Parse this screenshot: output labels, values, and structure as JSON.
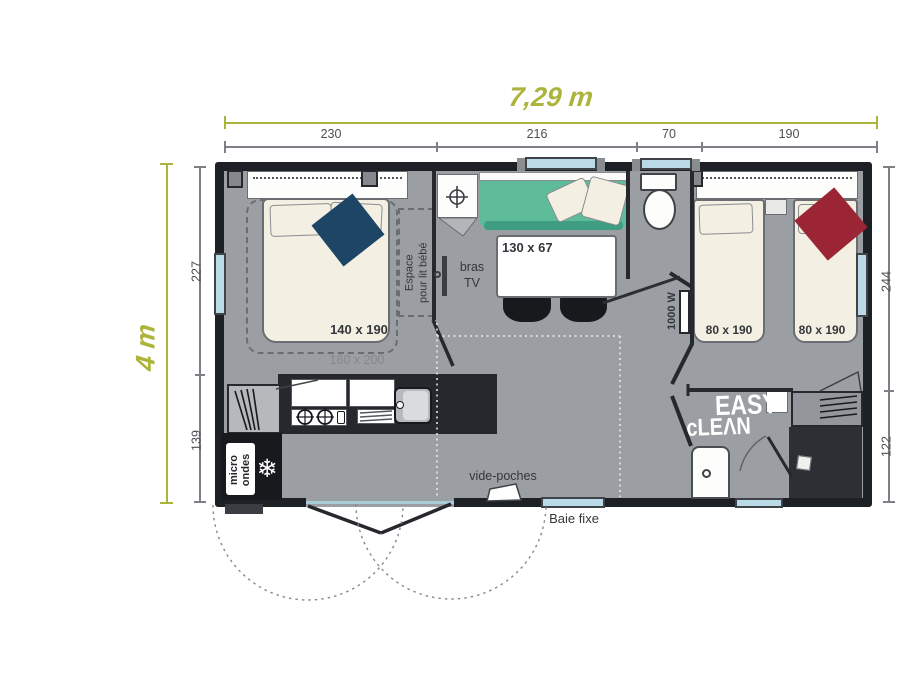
{
  "dimensions": {
    "overall_width": "7,29 m",
    "overall_height": "4 m",
    "top_segments": [
      "230",
      "216",
      "70",
      "190"
    ],
    "left_segments": [
      "227",
      "139"
    ],
    "right_segments": [
      "244",
      "122"
    ]
  },
  "rooms": {
    "master_bedroom": {
      "bed_size": "140 x 190",
      "bed_option_size": "160 x 200",
      "baby_space_line1": "Espace",
      "baby_space_line2": "pour lit bébé"
    },
    "living": {
      "table_size": "130 x 67",
      "tv_line1": "bras",
      "tv_line2": "TV"
    },
    "wc": {
      "heater_power": "1000 W"
    },
    "kids_bedroom": {
      "bed1_size": "80 x 190",
      "bed2_size": "80 x 190"
    },
    "bathroom": {
      "logo_line1": "EASY",
      "logo_line2": "cLEΛN"
    },
    "kitchen": {
      "microwave_line1": "micro",
      "microwave_line2": "ondes",
      "freezer_icon": "❄"
    }
  },
  "annotations": {
    "pocket": "vide-poches",
    "fixed_bay": "Baie fixe"
  },
  "colors": {
    "accent_olive": "#adb43c",
    "floor": "#9b9ea2",
    "wall": "#1d2025",
    "sofa_teal": "#5fbc9b",
    "throw_navy": "#1d4566",
    "throw_red": "#9b2535",
    "window_blue": "#b9dae6",
    "bed_cream": "#f3efe2"
  }
}
